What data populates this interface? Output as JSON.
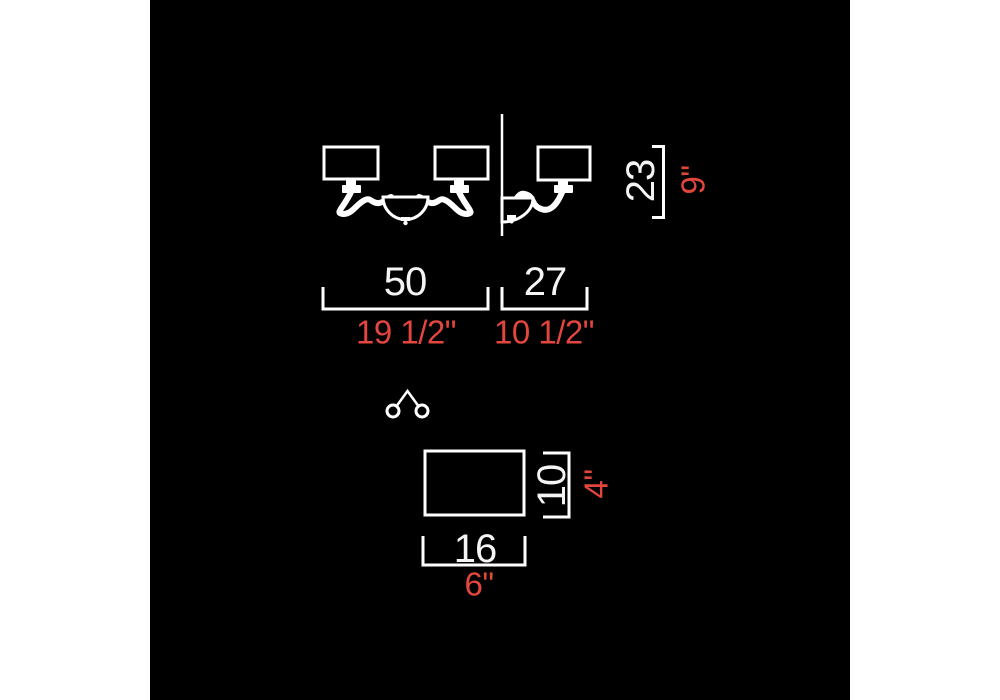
{
  "diagram": {
    "type": "lighting-fixture-dimension-drawing",
    "subject": "two-light wall sconce with rectangular shades",
    "colors": {
      "canvas_background": "#000000",
      "page_margin": "#ffffff",
      "line_color": "#ffffff",
      "metric_label_color": "#f5f5f5",
      "imperial_label_color": "#e2463c"
    },
    "views": {
      "front_view": "two shades with s-curved arms and center bowl",
      "side_view": "single shade profile against wall line",
      "top_view_icon": "two circles joined at a peak",
      "shade_detail": "single shade rectangle"
    },
    "dimensions": {
      "fixture_width": {
        "metric": "50",
        "imperial": "19 1/2\""
      },
      "fixture_depth": {
        "metric": "27",
        "imperial": "10 1/2\""
      },
      "fixture_height": {
        "metric": "23",
        "imperial": "9\""
      },
      "shade_width": {
        "metric": "16",
        "imperial": "6\""
      },
      "shade_height": {
        "metric": "10",
        "imperial": "4\""
      }
    }
  }
}
